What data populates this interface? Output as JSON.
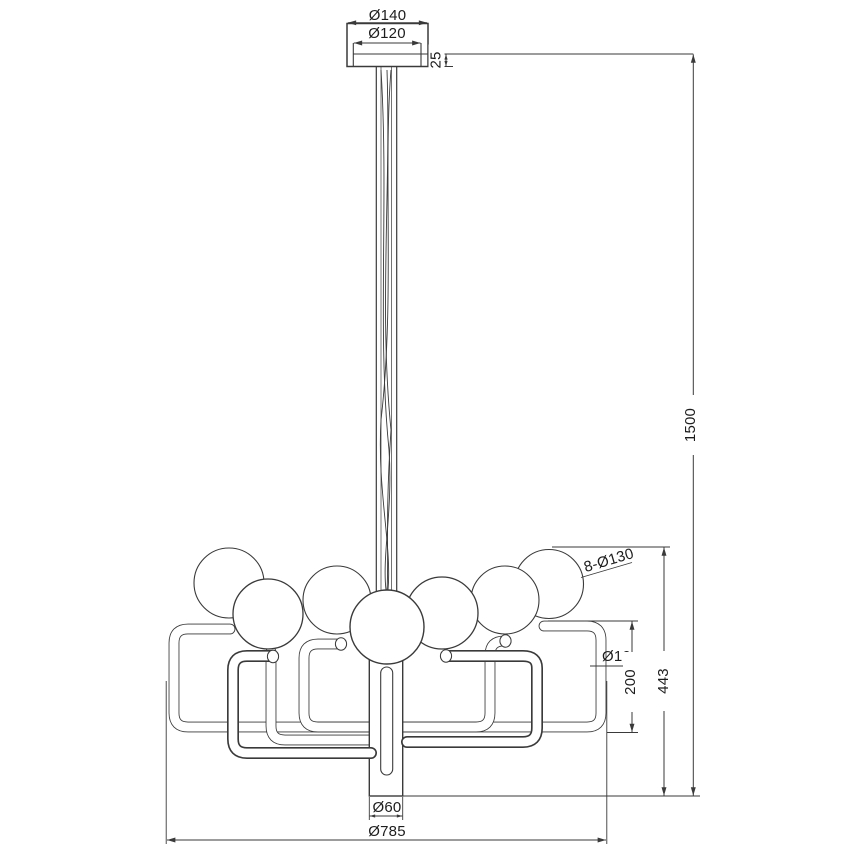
{
  "colors": {
    "line": "#3a3a3a",
    "text": "#1d1d1d",
    "background": "#ffffff"
  },
  "dimensions": {
    "canopy_outer_diameter": "Ø140",
    "canopy_inner_diameter": "Ø120",
    "canopy_height": "25",
    "suspension_length": "1500",
    "globes": "8-Ø130",
    "arm_tube_diameter": "Ø19",
    "arm_section_height": "200",
    "fixture_height": "443",
    "center_stem_diameter": "Ø60",
    "overall_diameter": "Ø785"
  }
}
